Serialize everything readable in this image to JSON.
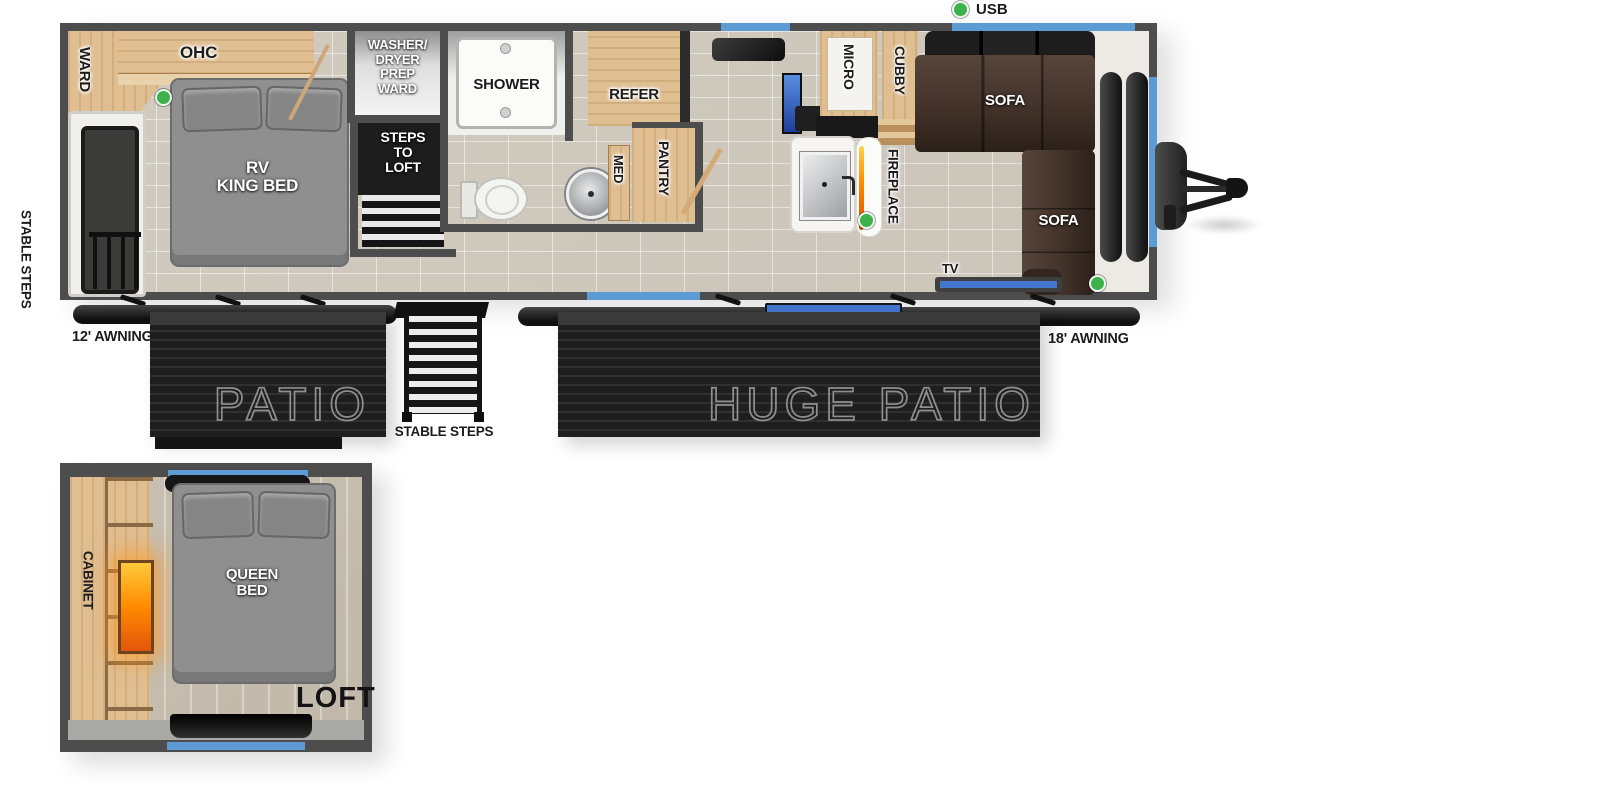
{
  "colors": {
    "wall": "#4d4d4d",
    "floor": "#d8d2c8",
    "wood": "#dfbe92",
    "wood_dark": "#b98f5c",
    "bed_gray": "#8f8f8f",
    "sofa_brown": "#42322a",
    "patio_dark": "#242424",
    "patio_text": "#8f8f8f",
    "window_blue": "#5c9bd3",
    "door_blue": "#4576cd",
    "usb_green": "#3bb24a",
    "flame": "#ff8a00",
    "label_dark": "#1c1c1c"
  },
  "legend": {
    "usb": "USB"
  },
  "main": {
    "ward": "WARD",
    "ohc": "OHC",
    "bed": "RV\nKING BED",
    "washer_ward": "WASHER/\nDRYER\nPREP\nWARD",
    "steps_to_loft": "STEPS\nTO\nLOFT",
    "shower": "SHOWER",
    "med": "MED",
    "refer": "REFER",
    "pantry": "PANTRY",
    "micro": "MICRO",
    "cubby": "CUBBY",
    "fireplace": "FIREPLACE",
    "sofa_rear": "SOFA",
    "sofa_side": "SOFA",
    "tv": "TV"
  },
  "exterior": {
    "stable_steps_door": "STABLE STEPS",
    "awning_left": "12' AWNING",
    "patio": "PATIO",
    "stable_steps_patio": "STABLE STEPS",
    "huge_patio": "HUGE PATIO",
    "awning_right": "18' AWNING"
  },
  "loft": {
    "cabinet": "CABINET",
    "bed": "QUEEN\nBED",
    "title": "LOFT"
  }
}
